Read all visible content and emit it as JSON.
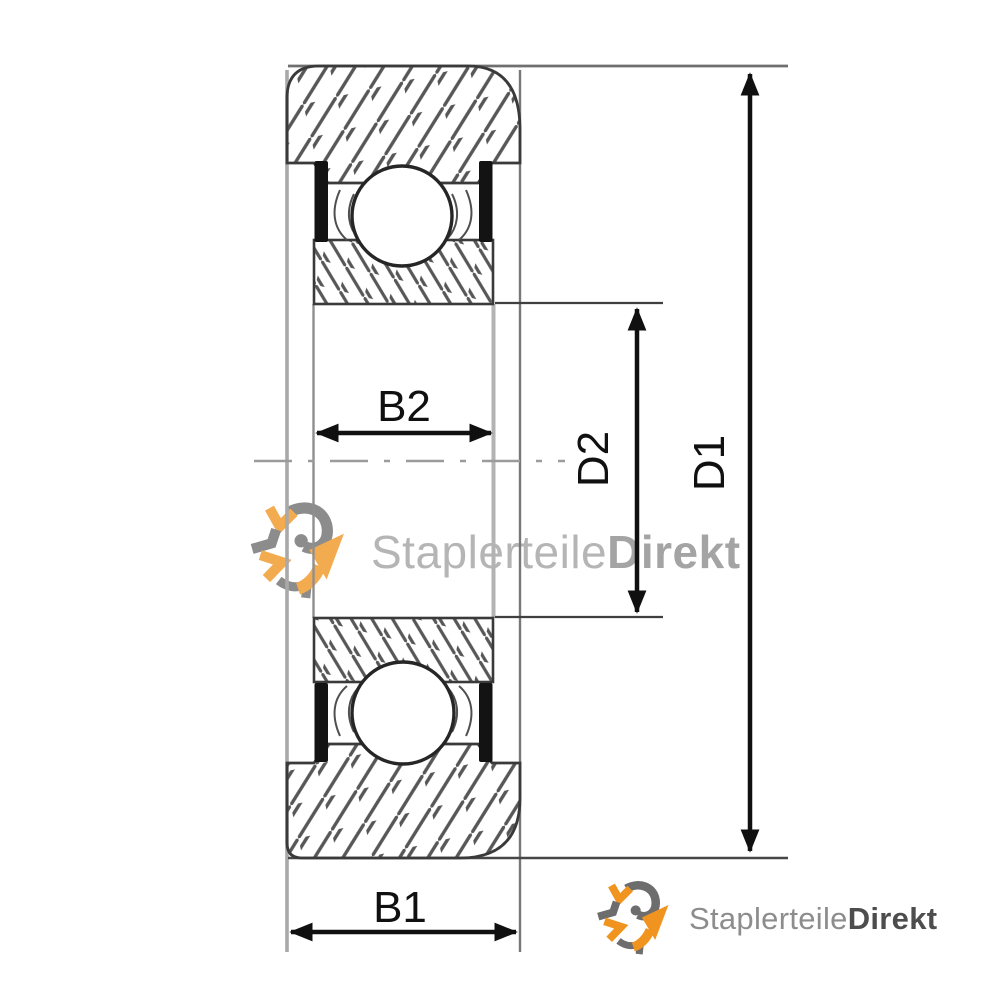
{
  "drawing": {
    "type": "bearing-cross-section-technical-drawing",
    "dimension_labels": {
      "b1": "B1",
      "b2": "B2",
      "d1": "D1",
      "d2": "D2"
    }
  },
  "watermark": {
    "brand_regular": "Staplerteile",
    "brand_bold": "Direkt",
    "icon": "circular-arrows-logo-icon"
  },
  "footer_logo": {
    "brand_regular": "Staplerteile",
    "brand_bold": "Direkt",
    "icon": "circular-arrows-logo-icon"
  },
  "colors": {
    "accent_orange": "#f0941f",
    "logo_gray": "#6d6d6d",
    "dimension_black": "#101010",
    "seal_black": "#131313",
    "hatch_gray": "#575757",
    "outline_dark": "#3a3a3a",
    "profile_gray": "#a6a6a6",
    "centerline_gray": "#9b9b9b",
    "watermark_text_regular": "#b5b5b5",
    "watermark_text_bold": "#a4a4a4",
    "footer_text_regular": "#8d8d8d",
    "footer_text_bold": "#4d4d4d",
    "background": "#ffffff"
  }
}
